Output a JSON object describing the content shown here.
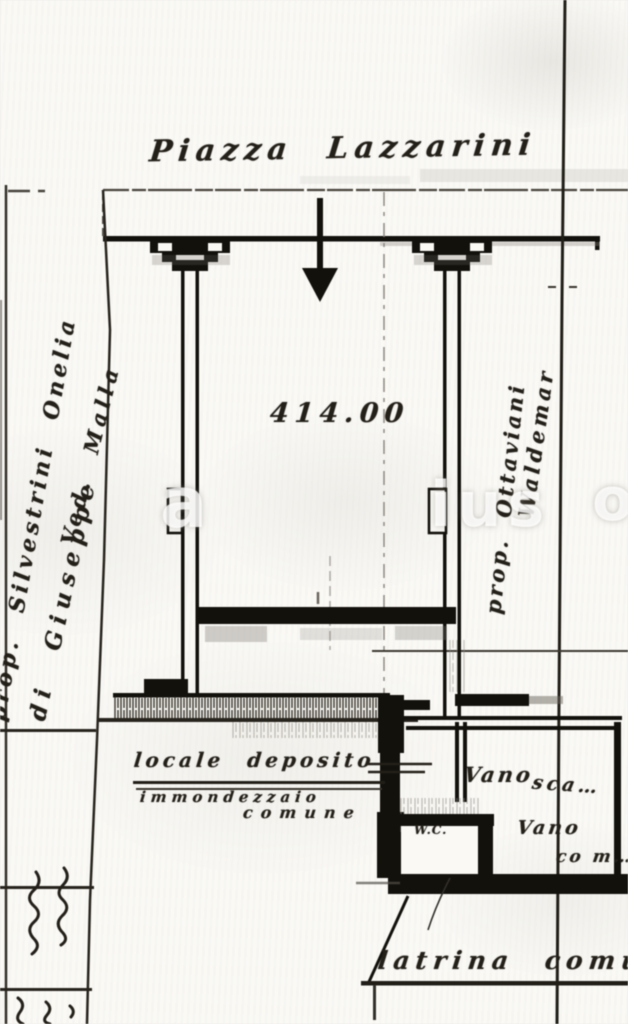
{
  "plan": {
    "street_label": "Piazza Lazzarini",
    "area_number": "414.00",
    "owner_left": {
      "line1": "prop. Silvestrini Onelia",
      "line2": "di Giuseppe",
      "line3": "Ved. Malla"
    },
    "owner_right": {
      "line1": "prop. Ottaviani",
      "line2": "Waldemar"
    },
    "deposit": {
      "line1": "locale deposito",
      "line2": "immondezzaio",
      "line3": "comune"
    },
    "rooms": {
      "vano1": "Vano",
      "vano1_fragment": "sca…",
      "vano2": "Vano",
      "vano2_fragment": "co m…",
      "wc": "W.C.",
      "latrina": "latrina comu"
    },
    "watermark": {
      "f1": "a",
      "f2": "ius",
      "f3": "o"
    },
    "colors": {
      "paper": "#f6f5f1",
      "ink": "#211e19",
      "faint": "#8d8881"
    }
  }
}
